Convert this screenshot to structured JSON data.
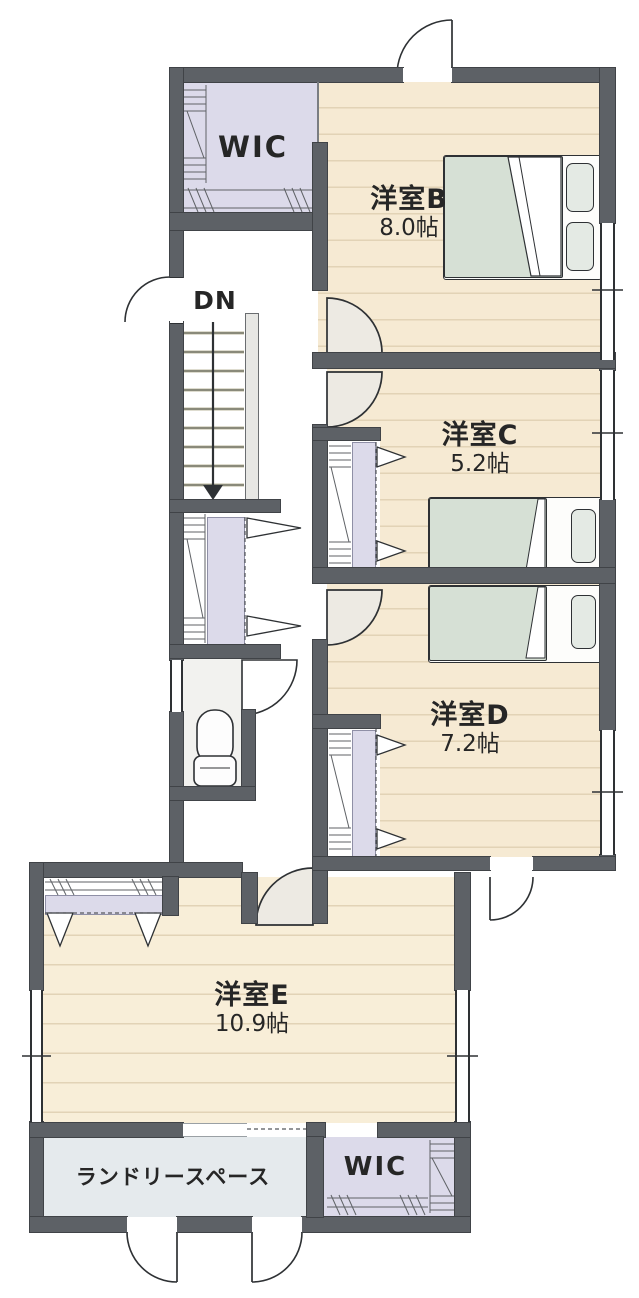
{
  "floorplan": {
    "title": "2F floor plan",
    "rooms": [
      {
        "id": "wic-upper",
        "label": "WIC",
        "size": ""
      },
      {
        "id": "bedroom-b",
        "label": "洋室B",
        "size": "8.0帖"
      },
      {
        "id": "bedroom-c",
        "label": "洋室C",
        "size": "5.2帖"
      },
      {
        "id": "bedroom-d",
        "label": "洋室D",
        "size": "7.2帖"
      },
      {
        "id": "bedroom-e",
        "label": "洋室E",
        "size": "10.9帖"
      },
      {
        "id": "laundry",
        "label": "ランドリースペース",
        "size": ""
      },
      {
        "id": "wic-lower",
        "label": "WIC",
        "size": ""
      }
    ],
    "stairs": {
      "label": "DN",
      "direction": "down"
    },
    "palette": {
      "wall": "#5d6166",
      "wallEdge": "#404347",
      "floorWood": "#f6ead3",
      "floorWoodLine": "#e2d3b6",
      "floorWoodE": "#f8eed8",
      "lavender": "#dcdaea",
      "laundryFloor": "#e5eaed",
      "toiletFloor": "#f2f2ef",
      "hallShade": "#edeae3",
      "bedGreen": "#d6e0d5",
      "pillow": "#e4eae4",
      "line": "#2e3134",
      "tread": "#b9b79a",
      "handrail": "#e7e7e4"
    }
  }
}
